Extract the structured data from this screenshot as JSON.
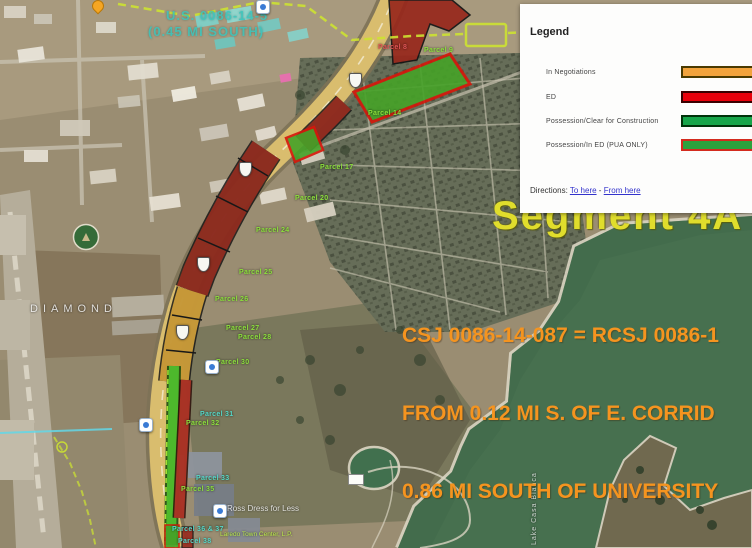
{
  "legend": {
    "title": "Legend",
    "items": [
      {
        "label": "In Negotiations",
        "color": "#F2A33C",
        "border": "#4a3a00"
      },
      {
        "label": "ED",
        "color": "#E8000B",
        "border": "#3a0000"
      },
      {
        "label": "Possession/Clear for Construction",
        "color": "#17A54A",
        "border": "#00330a"
      },
      {
        "label": "Possession/In ED (PUA ONLY)",
        "color": "#2BA23D",
        "border": "#D42B1E"
      }
    ],
    "directions": {
      "prefix": "Directions:",
      "to": "To here",
      "separator": "-",
      "from": "From here"
    }
  },
  "overlays": {
    "segment_text": "Segment 4A - 2",
    "csj_lines": [
      "CSJ 0086-14-087 = RCSJ 0086-1",
      "FROM 0.12 MI S. OF E. CORRID",
      "0.86 MI SOUTH OF UNIVERSITY"
    ],
    "top_note_lines": [
      "U.S. 0086-14-5",
      "(0.45 MI SOUTH)"
    ]
  },
  "map": {
    "parcel_labels": [
      {
        "text": "Parcel 8"
      },
      {
        "text": "Parcel 9"
      },
      {
        "text": "Parcel 14"
      },
      {
        "text": "Parcel 17"
      },
      {
        "text": "Parcel 20"
      },
      {
        "text": "Parcel 24"
      },
      {
        "text": "Parcel 25"
      },
      {
        "text": "Parcel 26"
      },
      {
        "text": "Parcel 27"
      },
      {
        "text": "Parcel 28"
      },
      {
        "text": "Parcel 30"
      },
      {
        "text": "Parcel 31"
      },
      {
        "text": "Parcel 32"
      },
      {
        "text": "Parcel 33"
      },
      {
        "text": "Parcel 35"
      },
      {
        "text": "Parcel 36 & 37"
      },
      {
        "text": "Parcel 38"
      }
    ],
    "place_labels": {
      "diamond": "DIAMOND",
      "ross": "Ross Dress for Less",
      "town_center": "Laredo Town Center, L.P.",
      "lake": "Lake Casa Blanca"
    }
  },
  "colors": {
    "csj_text_orange": "#F5941F",
    "segment_yellow": "#E0DD2C",
    "teal_label": "#3EC8BE",
    "lime_label": "#8CE03C",
    "route_dash_yellow": "#CDE332",
    "water_green": "#47704F"
  }
}
